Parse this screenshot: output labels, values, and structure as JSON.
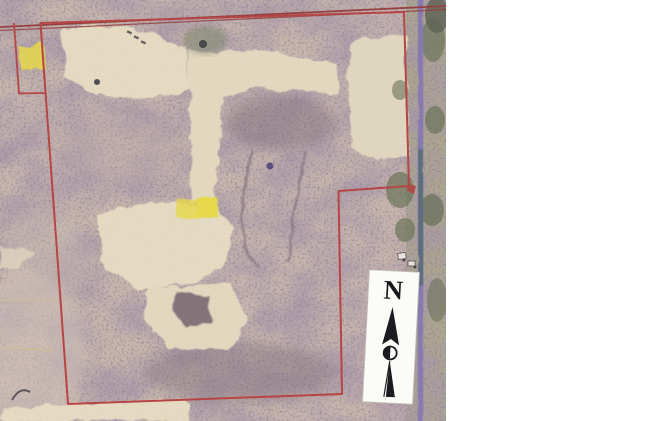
{
  "map": {
    "description": "Scanned aerial photograph of a wooded parcel with red surveyed property boundary outline, highlighted lots, creek corridor and north arrow",
    "north_label": "N",
    "colors": {
      "boundary": "#b53434",
      "road": "#8e2f2e",
      "highlight": "#efe23a",
      "field": "#e9e1c4",
      "woods": "#9b8a92",
      "creek": "#7b72b3",
      "arrow_box": "#fbfbf7",
      "background": "#ffffff"
    }
  }
}
